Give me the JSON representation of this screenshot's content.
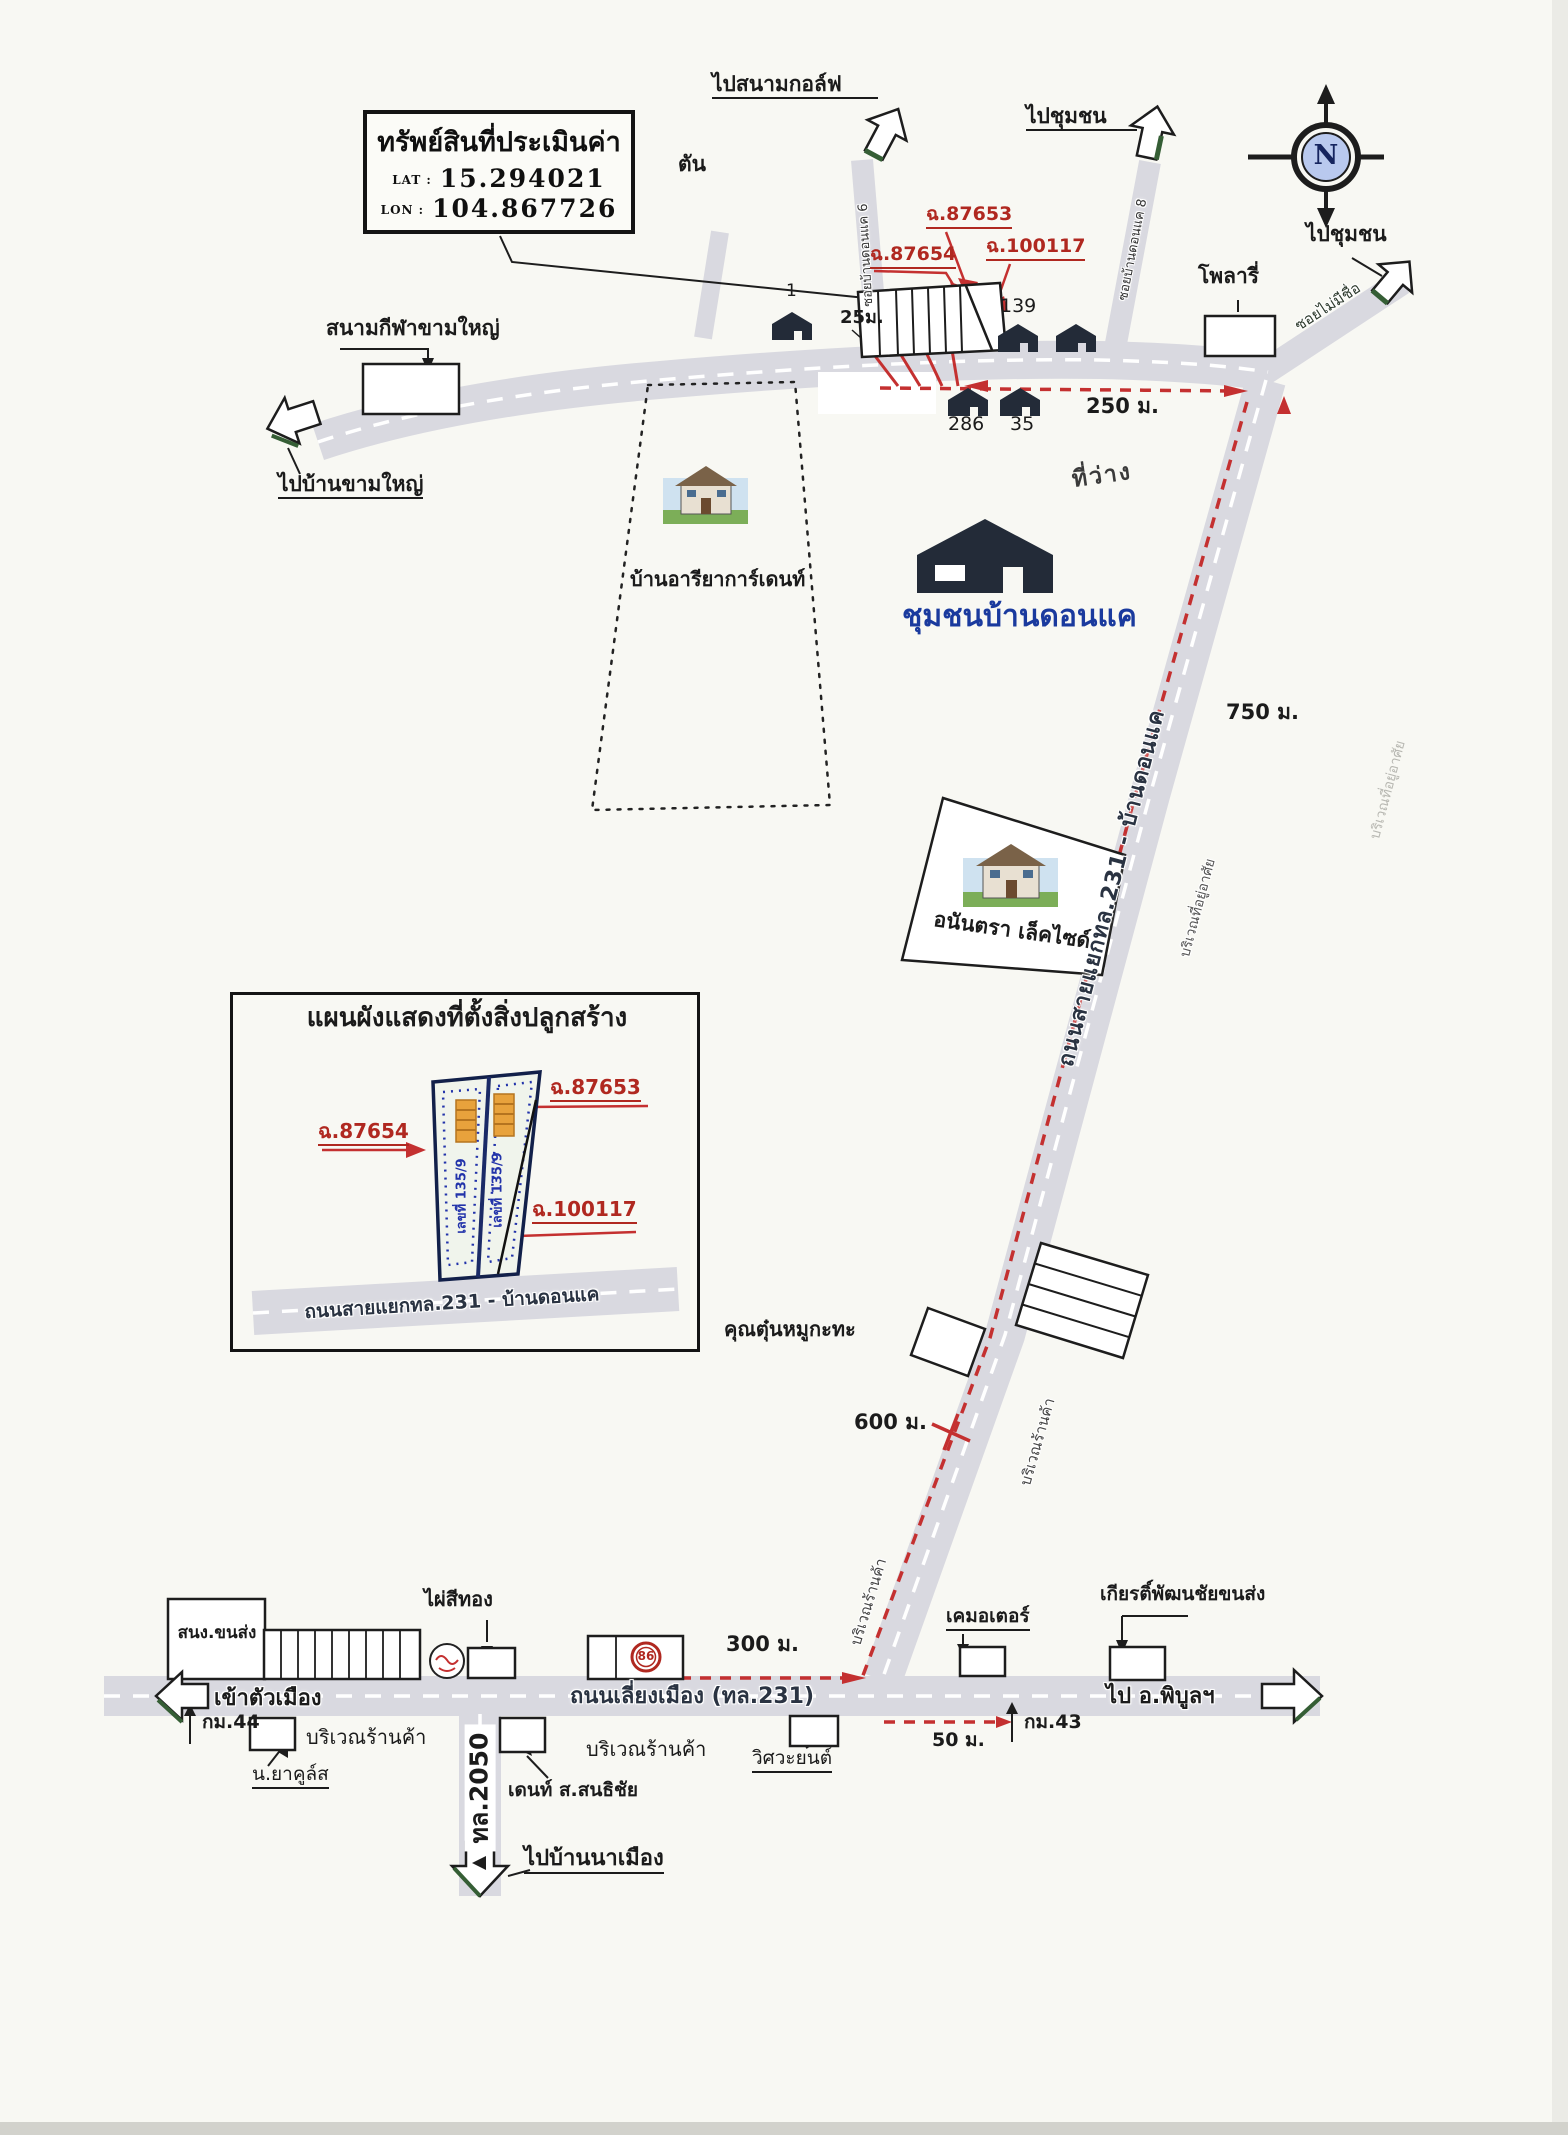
{
  "title_box": {
    "title": "ทรัพย์สินที่ประเมินค่า",
    "lat_label": "LAT :",
    "lat_value": "15.294021",
    "lon_label": "LON :",
    "lon_value": "104.867726"
  },
  "compass": {
    "n": "N"
  },
  "top": {
    "to_golf": "ไปสนามกอล์ฟ",
    "dead_end": "ตัน",
    "to_community_left": "ไปชุมชน",
    "to_community_right": "ไปชุมชน",
    "soi_dk6": "ซอยบ้านดอนแค 6",
    "soi_dk8": "ซอยบ้านดอนแค 8",
    "soi_unnamed": "ซอยไม่มีชื่อ",
    "polaris": "โพลารี่",
    "deed_87653": "ฉ.87653",
    "deed_87654": "ฉ.87654",
    "deed_100117": "ฉ.100117",
    "width_25m": "25ม.",
    "house_1": "1",
    "house_139": "139",
    "house_286": "286",
    "house_35": "35",
    "dist_250m": "250 ม.",
    "stadium": "สนามกีฬาขามใหญ่",
    "to_ban_kham_yai": "ไปบ้านขามใหญ่",
    "vacant": "ที่ว่าง"
  },
  "middle": {
    "ariya_garden": "บ้านอารียาการ์เดนท์",
    "community": "ชุมชนบ้านดอนแค",
    "anantara": "อนันตรา เล็คไซด์",
    "dist_750m": "750 ม.",
    "diag_road": "ถนนสายแยกทล.231 - บ้านดอนแค",
    "residential_a": "บริเวณที่อยู่อาศัย",
    "residential_b": "บริเวณที่อยู่อาศัย",
    "shops_a": "บริเวณร้านค้า",
    "shops_b": "บริเวณร้านค้า",
    "mookata": "คุณตุ๋นหมูกะทะ",
    "dist_600m": "600 ม."
  },
  "inset": {
    "title": "แผนผังแสดงที่ตั้งสิ่งปลูกสร้าง",
    "deed_87654": "ฉ.87654",
    "deed_87653": "ฉ.87653",
    "deed_100117": "ฉ.100117",
    "house_no_left": "เลขที่ 135/9",
    "house_no_right": "เลขที่ 135/9",
    "road": "ถนนสายแยกทล.231 - บ้านดอนแค"
  },
  "bottom": {
    "transport_office": "สนง.ขนส่ง",
    "phai_si_thong": "ไผ่สีทอง",
    "gas_86": "86",
    "dist_300m": "300 ม.",
    "k_motor": "เคมอเตอร์",
    "kiat_transport": "เกียรติ์พัฒนชัยขนส่ง",
    "road": "ถนนเลี่ยงเมือง (ทล.231)",
    "to_city": "เข้าตัวเมือง",
    "to_phibun": "ไป อ.พิบูลฯ",
    "km44": "กม.44",
    "km43": "กม.43",
    "dist_50m": "50 ม.",
    "shops_a": "บริเวณร้านค้า",
    "shops_b": "บริเวณร้านค้า",
    "yakult": "น.ยาคูล์ส",
    "dent": "เดนท์ ส.สนธิชัย",
    "wisawayon": "วิศวะยนต์",
    "tl2050": "ทล.2050",
    "to_ban_na_mueang": "ไปบ้านนาเมือง"
  },
  "colors": {
    "road": "#d9d9e0",
    "route_red": "#c43030",
    "deed_red": "#b02820",
    "community_blue": "#1a3a9e",
    "house_dark": "#232b38",
    "arrow_green": "#355e35"
  }
}
